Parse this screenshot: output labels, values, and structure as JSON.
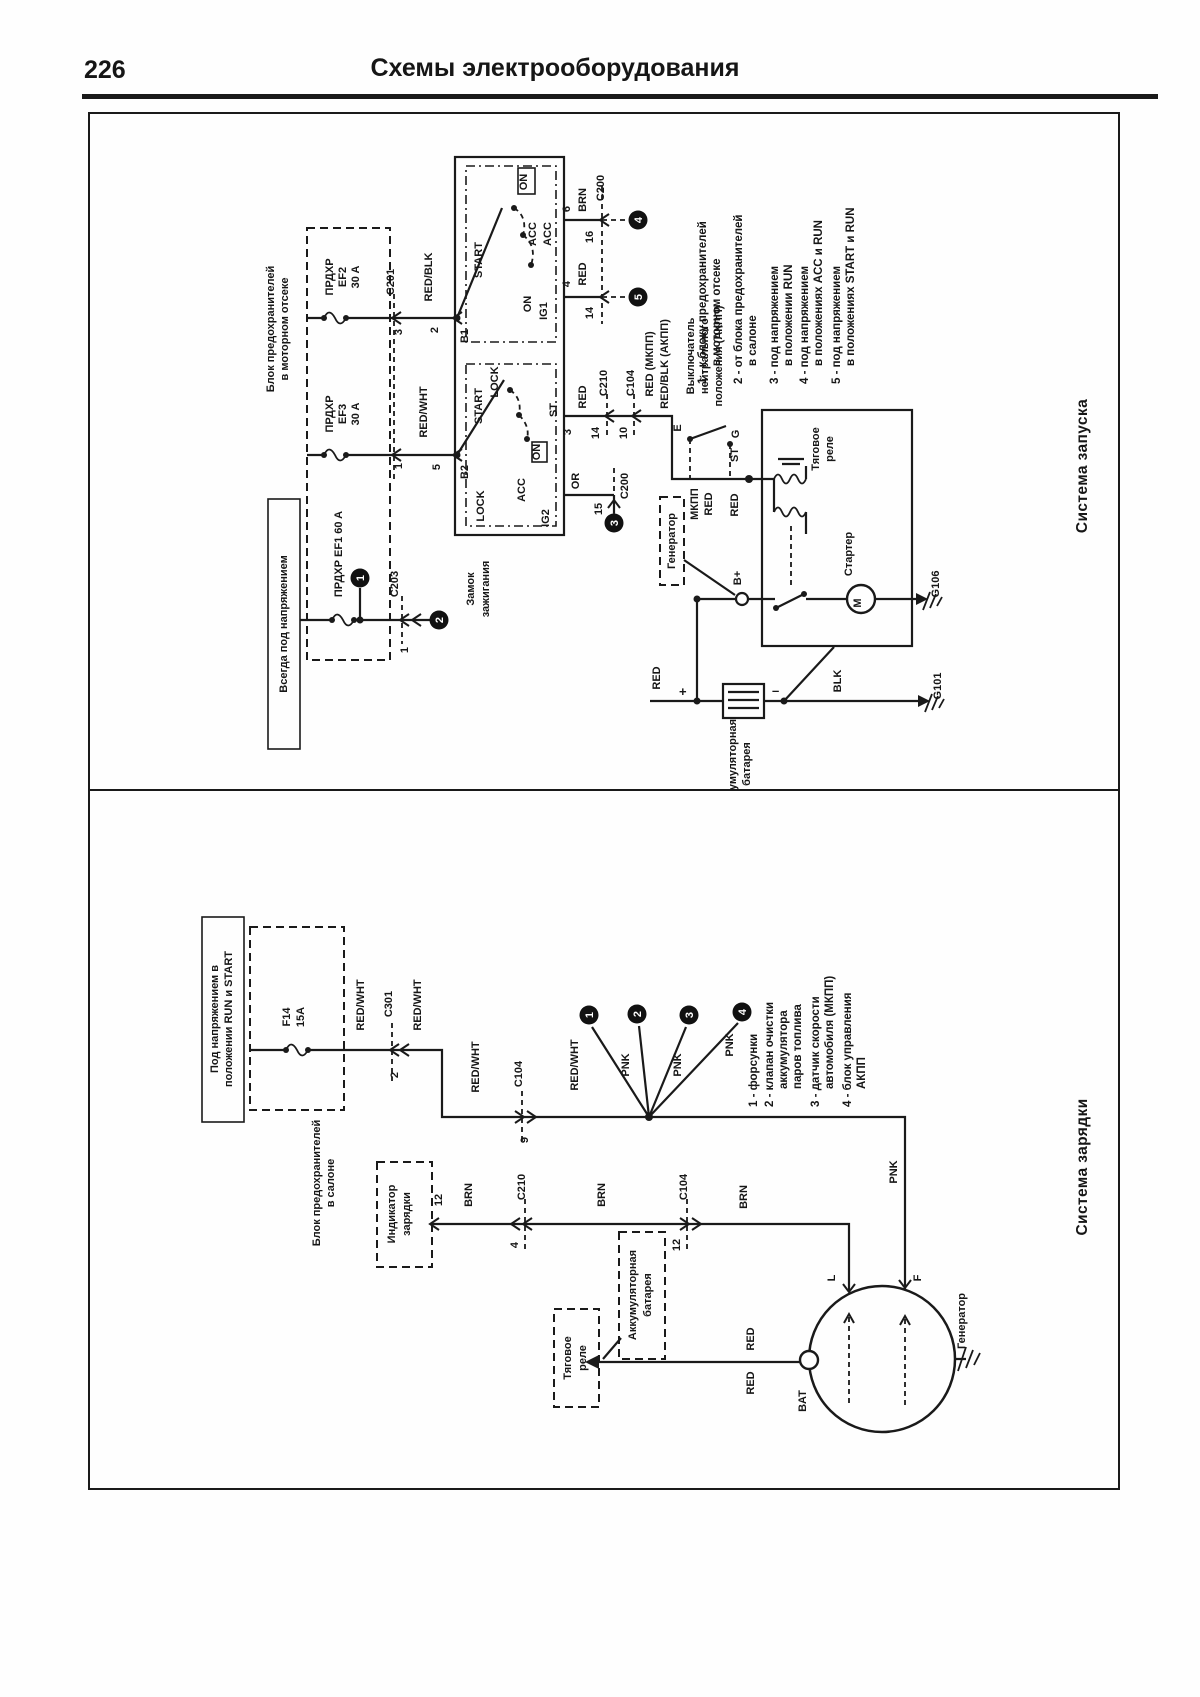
{
  "page": {
    "number": "226",
    "title": "Схемы электрооборудования"
  },
  "w": {
    "red": "RED",
    "redwht": "RED/WHT",
    "redblk": "RED/BLK",
    "brn": "BRN",
    "or": "OR",
    "blk": "BLK",
    "pnk": "PNK",
    "plus": "+",
    "minus": "–"
  },
  "c": {
    "c104": "C104",
    "c200": "C200",
    "c201": "C201",
    "c203": "C203",
    "c210": "C210",
    "c301": "C301",
    "g101": "G101",
    "g106": "G106"
  },
  "pin": {
    "p1": "1",
    "p2": "2",
    "p3": "3",
    "p4": "4",
    "p5": "5",
    "p6": "6",
    "p9": "9",
    "p10": "10",
    "p12": "12",
    "p14": "14",
    "p15": "15",
    "p16": "16"
  },
  "sw": {
    "lock": "LOCK",
    "acc": "ACC",
    "on": "ON",
    "start": "START",
    "ig1": "IG1",
    "ig2": "IG2",
    "st": "ST",
    "b1": "B1",
    "b2": "B2",
    "e": "E",
    "g": "G",
    "m": "M",
    "bplus": "B+",
    "bat": "BAT",
    "l": "L",
    "f": "F"
  },
  "start": {
    "title": "Система запуска",
    "always_hot": "Всегда под напряжением",
    "engine_fusebox_l1": "Блок предохранителей",
    "engine_fusebox_l2": "в моторном отсеке",
    "prdxr": "ПРДХР",
    "ef2": "EF2",
    "ef3": "EF3",
    "a30": "30 A",
    "fuse_ef1": "ПРДХР EF1 60 A",
    "ignition_l1": "Замок",
    "ignition_l2": "зажигания",
    "neutral_l1": "Выключатель",
    "neutral_l2": "нейтрального",
    "neutral_l3": "положения (АКПП)",
    "red_mt": "RED (МКПП)",
    "redblk_at": "RED/BLK (АКПП)",
    "mkpp": "МКПП",
    "starter": "Стартер",
    "relay_l1": "Тяговое",
    "relay_l2": "реле",
    "generator": "Генератор",
    "battery_l1": "Аккумуляторная",
    "battery_l2": "батарея",
    "legend": [
      "1 - к блоку предохранителей",
      "в моторном отсеке",
      "2 - от блока предохранителей",
      "в салоне",
      "3 - под напряжением",
      "в положении RUN",
      "4 - под напряжением",
      "в положениях ACC и RUN",
      "5 - под напряжением",
      "в положениях START и RUN"
    ]
  },
  "charge": {
    "title": "Система зарядки",
    "hot_l1": "Под напряжением в",
    "hot_l2": "положении RUN и START",
    "cabin_l1": "Блок предохранителей",
    "cabin_l2": "в салоне",
    "f14_l1": "F14",
    "f14_l2": "15A",
    "ind_l1": "Индикатор",
    "ind_l2": "зарядки",
    "relay_l1": "Тяговое",
    "relay_l2": "реле",
    "bat_l1": "Аккумуляторная",
    "bat_l2": "батарея",
    "generator": "Генератор",
    "legend": [
      "1 - форсунки",
      "2 - клапан очистки",
      "аккумулятора",
      "паров топлива",
      "3 - датчик скорости",
      "автомобиля (МКПП)",
      "4 - блок управления",
      "АКПП"
    ]
  }
}
